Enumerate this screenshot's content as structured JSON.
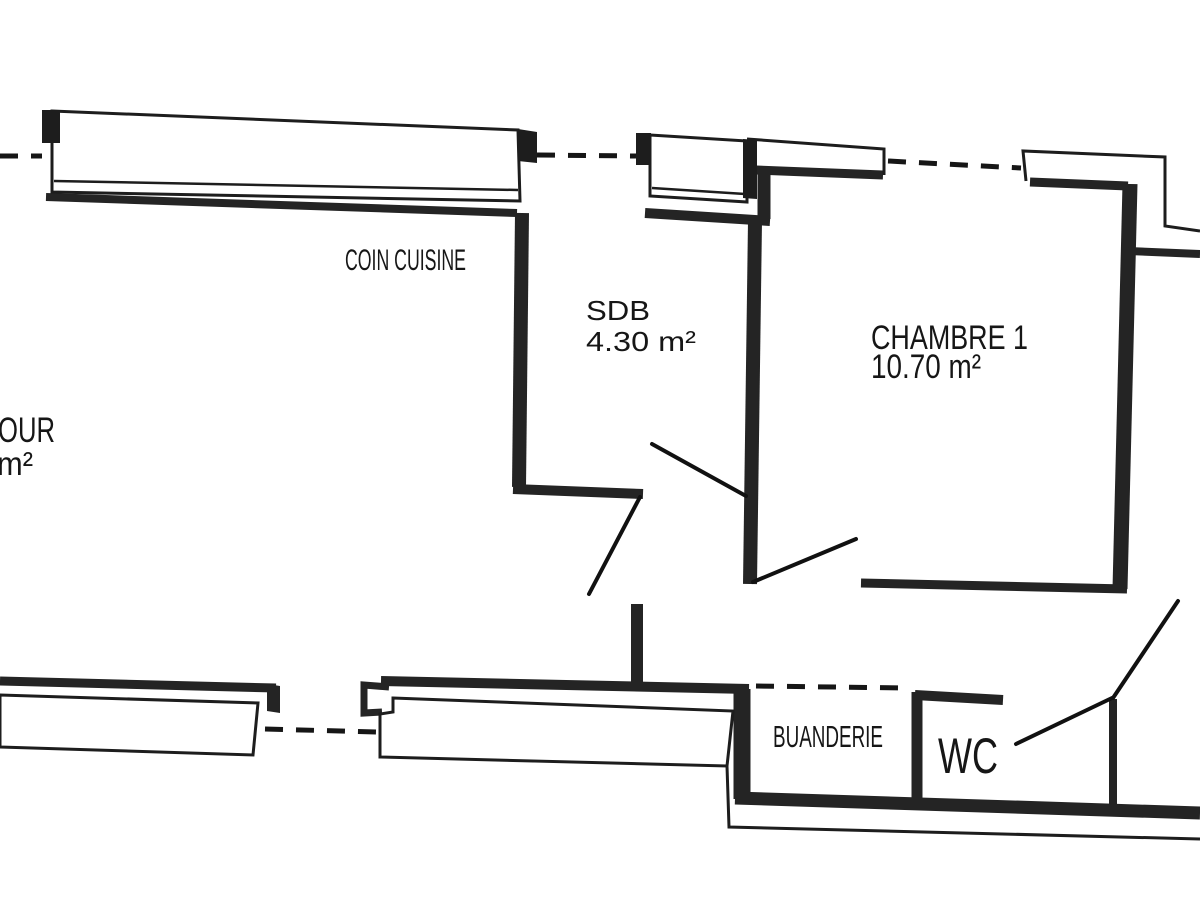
{
  "colors": {
    "background": "#ffffff",
    "ink": "#1d1d1d",
    "wall": "#242424"
  },
  "rooms": [
    {
      "label": "OUR",
      "area": "m²"
    },
    {
      "label": "COIN CUISINE",
      "area": ""
    },
    {
      "label": "SDB",
      "area": "4.30 m²"
    },
    {
      "label": "CHAMBRE 1",
      "area": "10.70 m²"
    },
    {
      "label": "BUANDERIE",
      "area": ""
    },
    {
      "label": "WC",
      "area": ""
    }
  ]
}
